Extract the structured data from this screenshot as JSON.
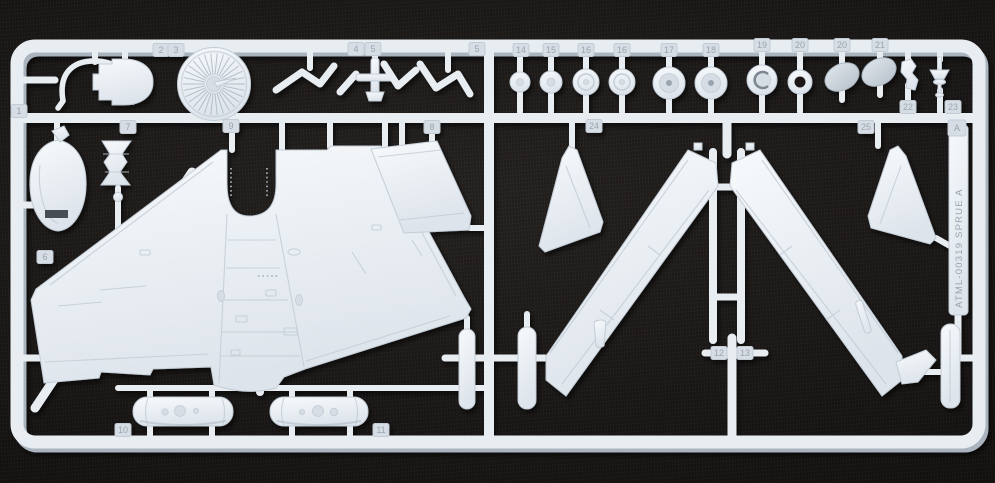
{
  "scene": {
    "description": "Photograph of an injection-moulded white polystyrene model-aircraft parts sprue lying on dark woven fabric"
  },
  "sprue": {
    "marking": "ATML-00319 SPRUE A",
    "number_tabs": [
      {
        "label": "1",
        "x": 19,
        "y": 111
      },
      {
        "label": "2",
        "x": 161,
        "y": 50
      },
      {
        "label": "3",
        "x": 176,
        "y": 50
      },
      {
        "label": "4",
        "x": 356,
        "y": 49
      },
      {
        "label": "5",
        "x": 373,
        "y": 49
      },
      {
        "label": "5",
        "x": 477,
        "y": 49
      },
      {
        "label": "6",
        "x": 45,
        "y": 257
      },
      {
        "label": "7",
        "x": 128,
        "y": 127
      },
      {
        "label": "9",
        "x": 231,
        "y": 126
      },
      {
        "label": "8",
        "x": 432,
        "y": 127
      },
      {
        "label": "24",
        "x": 594,
        "y": 126
      },
      {
        "label": "25",
        "x": 866,
        "y": 127
      },
      {
        "label": "A",
        "x": 957,
        "y": 128,
        "w": 18,
        "h": 16
      },
      {
        "label": "14",
        "x": 521,
        "y": 50
      },
      {
        "label": "15",
        "x": 551,
        "y": 50
      },
      {
        "label": "16",
        "x": 586,
        "y": 50
      },
      {
        "label": "16",
        "x": 622,
        "y": 50
      },
      {
        "label": "17",
        "x": 669,
        "y": 50
      },
      {
        "label": "18",
        "x": 711,
        "y": 50
      },
      {
        "label": "19",
        "x": 762,
        "y": 45
      },
      {
        "label": "20",
        "x": 800,
        "y": 45
      },
      {
        "label": "20",
        "x": 842,
        "y": 45
      },
      {
        "label": "21",
        "x": 880,
        "y": 45
      },
      {
        "label": "22",
        "x": 908,
        "y": 107
      },
      {
        "label": "23",
        "x": 953,
        "y": 107
      },
      {
        "label": "10",
        "x": 123,
        "y": 430
      },
      {
        "label": "11",
        "x": 381,
        "y": 430
      },
      {
        "label": "12",
        "x": 719,
        "y": 353
      },
      {
        "label": "13",
        "x": 745,
        "y": 353
      }
    ]
  },
  "colors": {
    "bg": "#151210",
    "pl_light": "#f7fafc",
    "pl_base": "#e8edf2",
    "pl_mid": "#d6dde4",
    "pl_dark": "#c3ccd5",
    "pl_shadow": "#a9b4bf",
    "engraved": "#9aa5b0",
    "slot_dark": "#474d54",
    "hole_dark": "#1a1816"
  }
}
